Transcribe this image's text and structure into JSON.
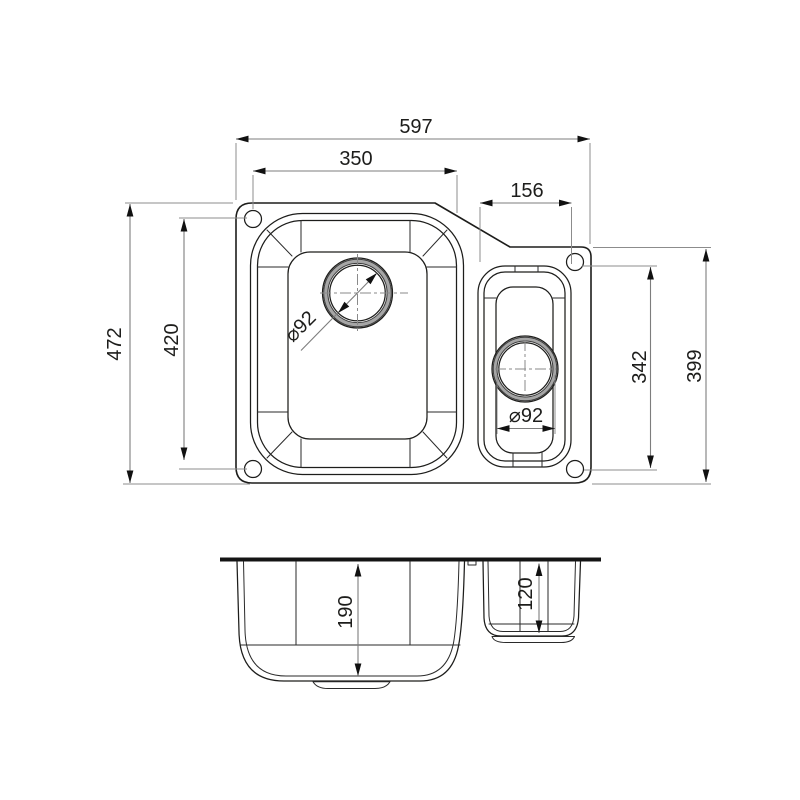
{
  "top_view": {
    "width_overall": "597",
    "main_bowl_width": "350",
    "small_bowl_width": "156",
    "height_overall": "472",
    "bolt_span_left": "420",
    "bolt_span_right": "342",
    "right_edge_height": "399",
    "main_drain_diameter": "⌀92",
    "small_drain_diameter": "⌀92"
  },
  "section_view": {
    "main_bowl_depth": "190",
    "small_bowl_depth": "120"
  },
  "colors": {
    "part_line": "#1d1d1b",
    "dimension_line": "#7d7d7d",
    "background": "#ffffff"
  }
}
